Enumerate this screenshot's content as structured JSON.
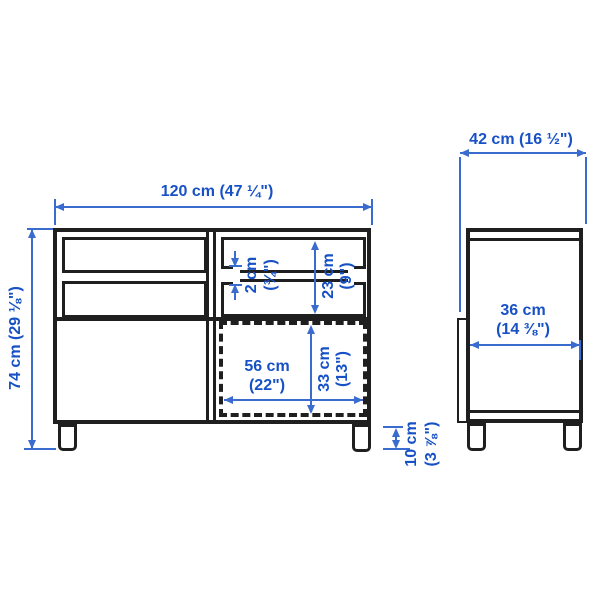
{
  "diagram_title": "furniture-dimension-drawing",
  "colors": {
    "background": "#ffffff",
    "outline": "#1f1f1f",
    "dimension_line": "#3a6cd0",
    "dimension_text": "#1751c5"
  },
  "front_view": {
    "overall_width": "120 cm (47 ¼\")",
    "overall_height": "74 cm (29 ⅛\")",
    "shelf_thickness_cm": "2 cm",
    "shelf_thickness_in": "(¾\")",
    "compartment_height_cm": "23 cm",
    "compartment_height_in": "(9\")",
    "door_width_cm": "56 cm",
    "door_width_in": "(22\")",
    "door_height_cm": "33 cm",
    "door_height_in": "(13\")",
    "leg_height_cm": "10 cm",
    "leg_height_in": "(3 ⅞\")"
  },
  "side_view": {
    "overall_depth": "42 cm (16 ½\")",
    "inner_depth_cm": "36 cm",
    "inner_depth_in": "(14 ⅜\")"
  }
}
